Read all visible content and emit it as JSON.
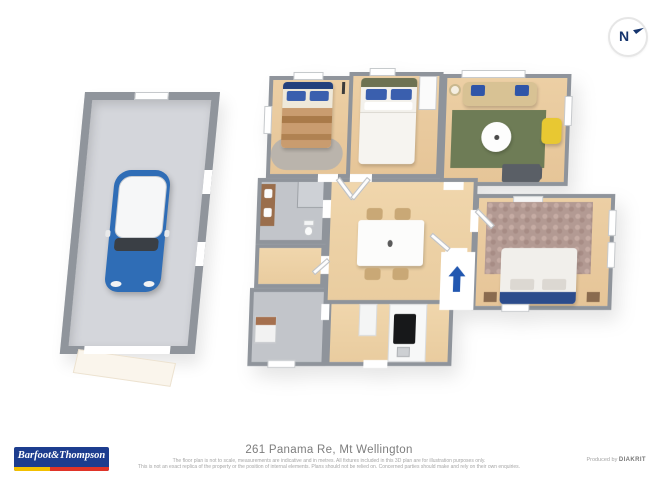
{
  "compass": {
    "label": "N"
  },
  "footer": {
    "title": "261 Panama Re, Mt Wellington",
    "disclaimer_line1": "The floor plan is not to scale, measurements are indicative and in metres. All fixtures included in this 3D plan are for illustration purposes only.",
    "disclaimer_line2": "This is not an exact replica of the property or the position of internal elements. Plans should not be relied on. Concerned parties should make and rely on their own enquiries.",
    "produced_by_label": "Produced by",
    "producer_name": "DIAKRIT",
    "brand_logo_text": "Barfoot&Thompson"
  },
  "floorplan": {
    "type": "3d-floor-plan",
    "rooms": [
      "garage",
      "bedroom-1",
      "bedroom-2",
      "living-room",
      "bathroom",
      "wc-hall",
      "laundry",
      "dining-kitchen",
      "bedroom-3"
    ],
    "entry_arrow_direction": "up"
  },
  "colors": {
    "brand_blue": "#1d3d8f",
    "brand_yellow": "#f3c000",
    "brand_red": "#e03428",
    "compass_navy": "#16356e",
    "entry_arrow_blue": "#2257b0",
    "wall_gray": "#8f949b",
    "wood_floor": "#e9cda3",
    "tile_gray": "#c2c5ca",
    "garage_floor": "#d4d6db",
    "rug_green": "#6e7c56",
    "rug_mauve": "#b39a93",
    "pillow_blue": "#3a5fae",
    "sofa_tan": "#d8c294",
    "armchair_yellow": "#e8c832",
    "car_blue": "#2f6db6"
  }
}
